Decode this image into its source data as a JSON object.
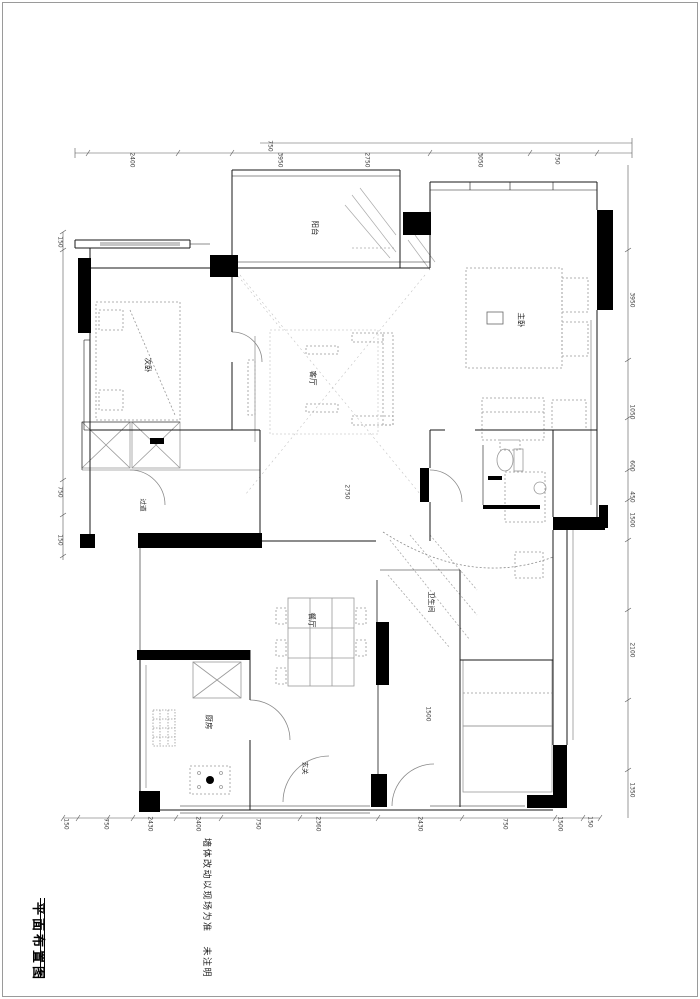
{
  "sheet": {
    "title": "平面布置图",
    "note_line1": "墙体改动以现场为准",
    "note_line2": "未注明"
  },
  "colors": {
    "wall_fill": "#000000",
    "outline": "#1a1a1a",
    "furniture": "#999999",
    "faint": "#bbbbbb",
    "dim_text": "#3a3a3a",
    "label_text": "#1f1f1f",
    "page_border": "#9a9a9a"
  },
  "rooms": [
    {
      "name": "balcony",
      "label": "阳台",
      "x": 315,
      "y": 228,
      "size": 7.5
    },
    {
      "name": "bedroom-2",
      "label": "次卧",
      "x": 148,
      "y": 365,
      "size": 7.5
    },
    {
      "name": "living-room",
      "label": "客厅",
      "x": 313,
      "y": 378,
      "size": 7.5
    },
    {
      "name": "master-bedroom",
      "label": "主卧",
      "x": 521,
      "y": 320,
      "size": 7.5
    },
    {
      "name": "dining-room",
      "label": "餐厅",
      "x": 312,
      "y": 620,
      "size": 7.5
    },
    {
      "name": "kitchen",
      "label": "厨房",
      "x": 209,
      "y": 722,
      "size": 7.5
    },
    {
      "name": "bathroom",
      "label": "卫生间",
      "x": 431,
      "y": 602,
      "size": 7
    },
    {
      "name": "hallway",
      "label": "过道",
      "x": 143,
      "y": 505,
      "size": 6.5
    },
    {
      "name": "entry",
      "label": "玄关",
      "x": 305,
      "y": 768,
      "size": 6.5
    }
  ],
  "dimensions": {
    "top": [
      {
        "text": "2400",
        "x": 132,
        "y": 160
      },
      {
        "text": "3950",
        "x": 280,
        "y": 160
      },
      {
        "text": "2750",
        "x": 367,
        "y": 160
      },
      {
        "text": "3050",
        "x": 480,
        "y": 160
      },
      {
        "text": "750",
        "x": 557,
        "y": 159
      },
      {
        "text": "750",
        "x": 270,
        "y": 146
      }
    ],
    "bottom": [
      {
        "text": "150",
        "x": 66,
        "y": 824
      },
      {
        "text": "750",
        "x": 106,
        "y": 824
      },
      {
        "text": "2430",
        "x": 150,
        "y": 824
      },
      {
        "text": "2400",
        "x": 198,
        "y": 824
      },
      {
        "text": "750",
        "x": 258,
        "y": 824
      },
      {
        "text": "2360",
        "x": 318,
        "y": 824
      },
      {
        "text": "2430",
        "x": 420,
        "y": 824
      },
      {
        "text": "750",
        "x": 505,
        "y": 824
      },
      {
        "text": "1500",
        "x": 560,
        "y": 824
      },
      {
        "text": "150",
        "x": 590,
        "y": 822
      }
    ],
    "right": [
      {
        "text": "3950",
        "x": 632,
        "y": 300
      },
      {
        "text": "1050",
        "x": 632,
        "y": 412
      },
      {
        "text": "600",
        "x": 632,
        "y": 466
      },
      {
        "text": "450",
        "x": 632,
        "y": 497
      },
      {
        "text": "1500",
        "x": 632,
        "y": 520
      },
      {
        "text": "2100",
        "x": 632,
        "y": 650
      },
      {
        "text": "1350",
        "x": 632,
        "y": 790
      }
    ],
    "left": [
      {
        "text": "150",
        "x": 60,
        "y": 242
      },
      {
        "text": "750",
        "x": 60,
        "y": 492
      },
      {
        "text": "150",
        "x": 60,
        "y": 540
      }
    ],
    "interior": [
      {
        "text": "2750",
        "x": 347,
        "y": 492
      },
      {
        "text": "1500",
        "x": 428,
        "y": 714
      }
    ]
  }
}
